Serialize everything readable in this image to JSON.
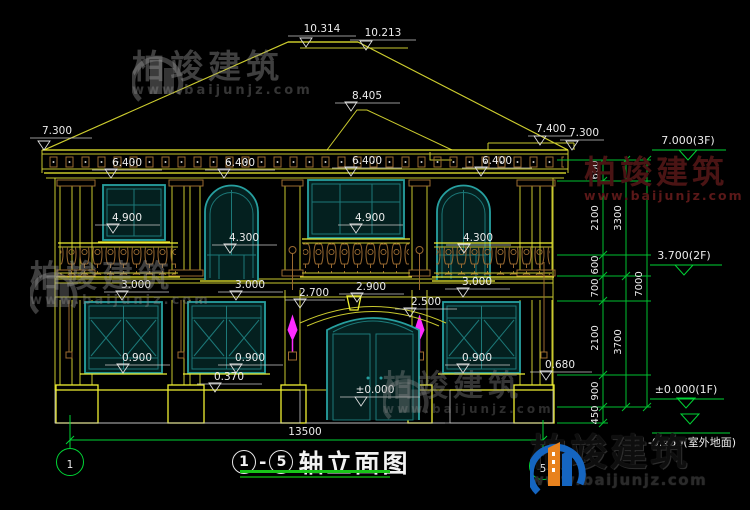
{
  "watermark": {
    "brand": "柏竣建筑",
    "url": "www.baijunjz.com"
  },
  "title": {
    "axis_start": "1",
    "dash": "-",
    "axis_end": "5",
    "text": "轴立面图"
  },
  "axes": {
    "left_bubble": "1",
    "right_bubble": "5"
  },
  "dims": {
    "total_width": "13500",
    "ridge_main": "10.314",
    "ridge_rear": "10.213",
    "porch_ridge": "8.405",
    "eave_left": "7.300",
    "eave_right_upper": "7.400",
    "eave_right": "7.300",
    "cornice": [
      "6.400",
      "6.400",
      "6.400",
      "6.400"
    ],
    "f2_sill_left": "4.900",
    "f2_arch_left": "4.300",
    "f2_sill_center": "4.900",
    "f2_arch_right": "4.300",
    "f1_header_left": "3.000",
    "f1_header_mid": "3.000",
    "f1_header_right": "3.000",
    "porch_left": "2.700",
    "porch_top": "2.900",
    "porch_right": "2.500",
    "f1_sill_left": "0.900",
    "f1_sill_mid": "0.900",
    "f1_sill_right": "0.900",
    "base_top": "0.370",
    "ledge_right": "0.680",
    "entry_level": "±0.000"
  },
  "chain": {
    "inner": [
      "600",
      "2100",
      "600",
      "700",
      "2100",
      "900",
      "450"
    ],
    "middle": [
      "3300",
      "3700"
    ],
    "total": "7000"
  },
  "levels": {
    "f3": "7.000(3F)",
    "f2": "3.700(2F)",
    "f1": "±0.000(1F)",
    "ground": "-0.450(室外地面)"
  }
}
